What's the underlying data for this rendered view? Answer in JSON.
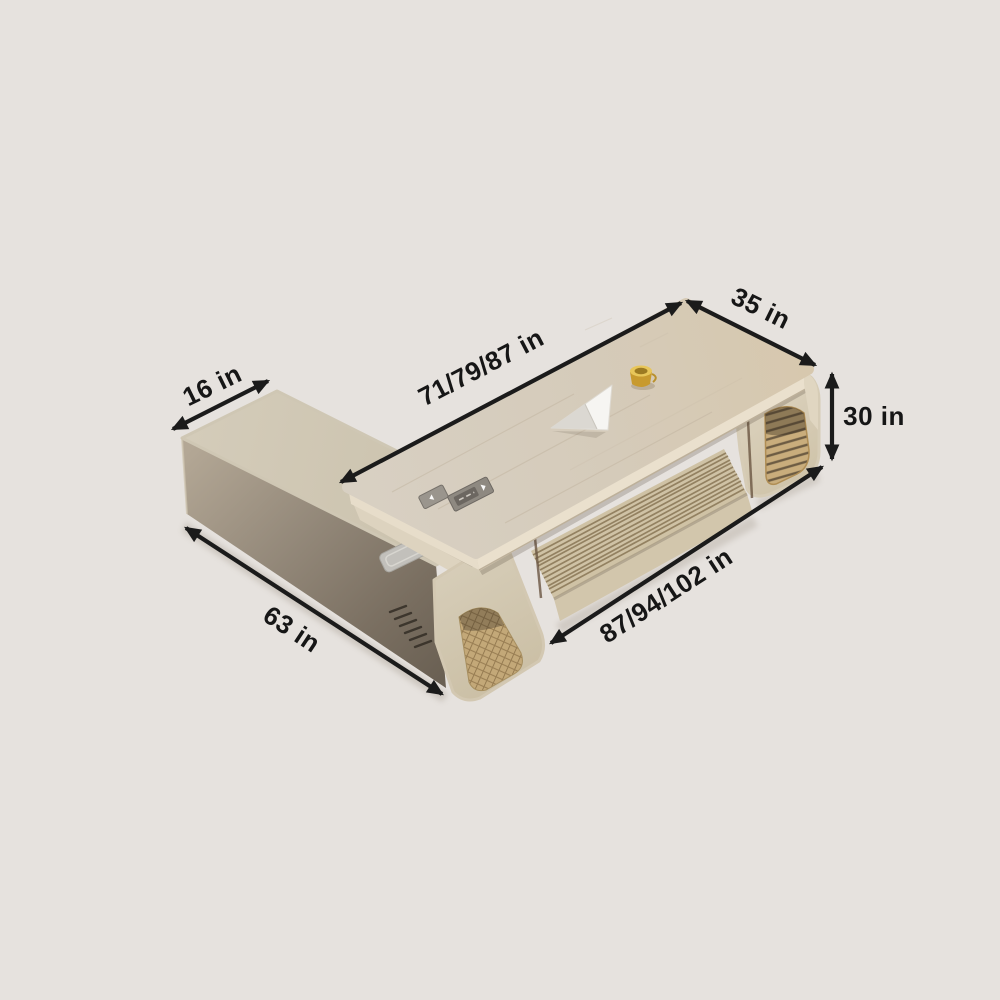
{
  "scene": {
    "description_unit": "in"
  },
  "dimensions": {
    "return_top_depth": {
      "label": "16 in"
    },
    "desktop_length": {
      "label": "71/79/87 in"
    },
    "desktop_depth": {
      "label": "35 in"
    },
    "desk_height": {
      "label": "30 in"
    },
    "overall_length": {
      "label": "87/94/102 in"
    },
    "return_length": {
      "label": "63 in"
    }
  },
  "palette": {
    "background": "#e6e2de",
    "annotation": "#1b1b1b",
    "desktop_wood": "#d7cebf",
    "desktop_edge": "#eae0cd",
    "cabinet_top": "#d0c8b5",
    "cabinet_front_dark": "#6a6053",
    "louver": "#cfc2a5",
    "cane_panel": "#c3a878",
    "gold_accent": "#c89a2e",
    "cable_cover": "#f6f5f2",
    "keypad": "#8e8981"
  }
}
